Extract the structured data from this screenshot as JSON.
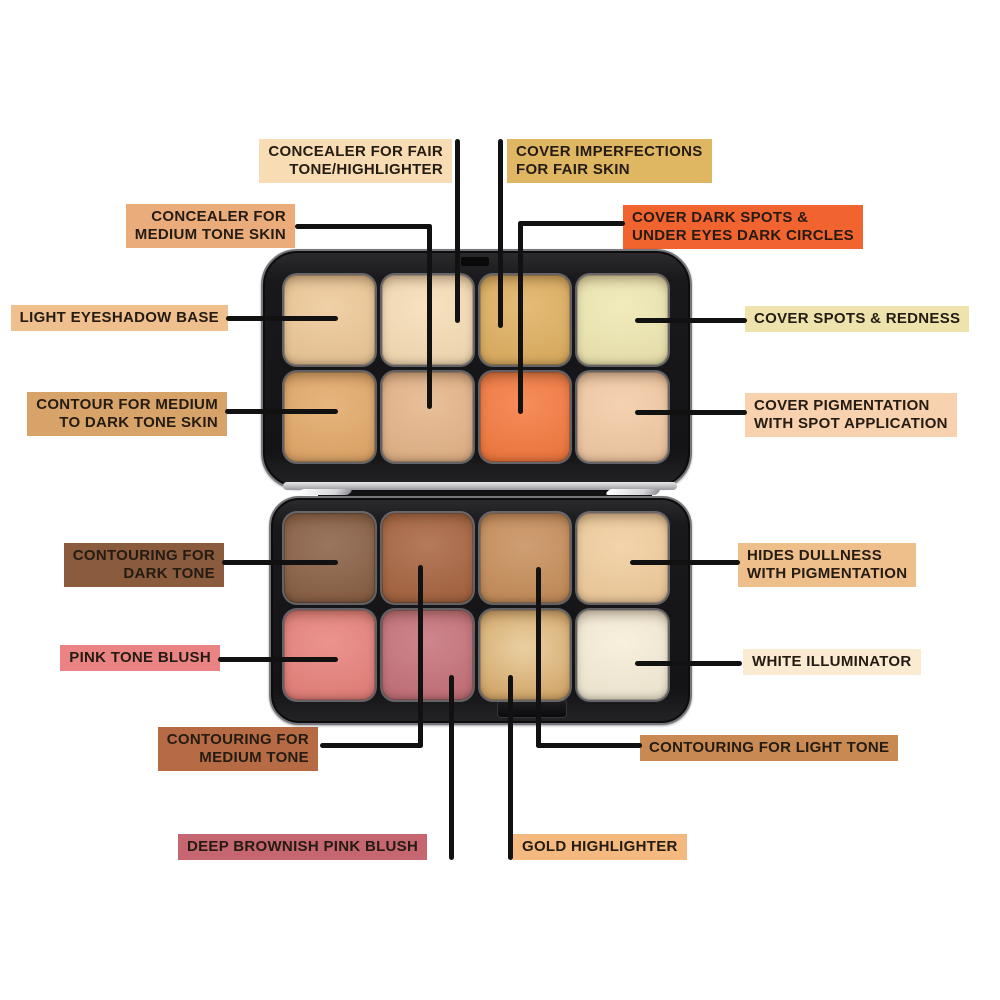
{
  "page": {
    "background": "#ffffff",
    "line_color": "#111111"
  },
  "palette": {
    "case_color": "#19191b",
    "top_pans": [
      {
        "name": "light-eyeshadow-base-pan",
        "color": "#EDC795"
      },
      {
        "name": "concealer-fair-highlighter-pan",
        "color": "#F6DCB3"
      },
      {
        "name": "cover-imperfections-fair-pan",
        "color": "#DFAE5D"
      },
      {
        "name": "cover-spots-redness-pan",
        "color": "#EFE7B0"
      },
      {
        "name": "contour-medium-dark-pan",
        "color": "#E2A765"
      },
      {
        "name": "concealer-medium-tone-pan",
        "color": "#E4B386"
      },
      {
        "name": "cover-dark-spots-pan",
        "color": "#F4773B"
      },
      {
        "name": "cover-pigmentation-pan",
        "color": "#F3C9A2"
      }
    ],
    "bottom_pans": [
      {
        "name": "contouring-dark-tone-pan",
        "color": "#875C40"
      },
      {
        "name": "contouring-medium-tone-pan",
        "color": "#A5613C"
      },
      {
        "name": "contouring-light-tone-pan",
        "color": "#C68C57"
      },
      {
        "name": "hides-dullness-pan",
        "color": "#F1CC9B"
      },
      {
        "name": "pink-tone-blush-pan",
        "color": "#E87F79"
      },
      {
        "name": "deep-brownish-pink-blush-pan",
        "color": "#C56E77"
      },
      {
        "name": "gold-highlighter-pan",
        "color": "#DBAD6C"
      },
      {
        "name": "white-illuminator-pan",
        "color": "#F6EDD6"
      }
    ]
  },
  "labels": [
    {
      "lines": [
        "CONCEALER FOR FAIR",
        "TONE/HIGHLIGHTER"
      ],
      "bg": "#F8DCB4",
      "points_to": "concealer-fair-highlighter-pan"
    },
    {
      "lines": [
        "COVER IMPERFECTIONS",
        "FOR FAIR SKIN"
      ],
      "bg": "#DFB763",
      "points_to": "cover-imperfections-fair-pan"
    },
    {
      "lines": [
        "CONCEALER FOR",
        "MEDIUM TONE SKIN"
      ],
      "bg": "#EBAC7C",
      "points_to": "concealer-medium-tone-pan"
    },
    {
      "lines": [
        "COVER DARK SPOTS &",
        "UNDER EYES DARK CIRCLES"
      ],
      "bg": "#F2642F",
      "points_to": "cover-dark-spots-pan"
    },
    {
      "lines": [
        "LIGHT EYESHADOW BASE"
      ],
      "bg": "#EFBF8D",
      "points_to": "light-eyeshadow-base-pan"
    },
    {
      "lines": [
        "COVER SPOTS & REDNESS"
      ],
      "bg": "#EEE3AC",
      "points_to": "cover-spots-redness-pan"
    },
    {
      "lines": [
        "CONTOUR FOR MEDIUM",
        "TO DARK TONE SKIN"
      ],
      "bg": "#D8A368",
      "points_to": "contour-medium-dark-pan"
    },
    {
      "lines": [
        "COVER PIGMENTATION",
        "WITH SPOT APPLICATION"
      ],
      "bg": "#F8D2AE",
      "points_to": "cover-pigmentation-pan"
    },
    {
      "lines": [
        "CONTOURING FOR",
        "DARK TONE"
      ],
      "bg": "#8A5B3D",
      "points_to": "contouring-dark-tone-pan"
    },
    {
      "lines": [
        "HIDES DULLNESS",
        "WITH PIGMENTATION"
      ],
      "bg": "#EEBE8B",
      "points_to": "hides-dullness-pan"
    },
    {
      "lines": [
        "PINK TONE BLUSH"
      ],
      "bg": "#EA8484",
      "points_to": "pink-tone-blush-pan"
    },
    {
      "lines": [
        "WHITE ILLUMINATOR"
      ],
      "bg": "#FAEBD2",
      "points_to": "white-illuminator-pan"
    },
    {
      "lines": [
        "CONTOURING FOR",
        "MEDIUM TONE"
      ],
      "bg": "#B66B44",
      "points_to": "contouring-medium-tone-pan"
    },
    {
      "lines": [
        "CONTOURING FOR LIGHT TONE"
      ],
      "bg": "#C88A52",
      "points_to": "contouring-light-tone-pan"
    },
    {
      "lines": [
        "DEEP BROWNISH PINK BLUSH"
      ],
      "bg": "#C56671",
      "points_to": "deep-brownish-pink-blush-pan"
    },
    {
      "lines": [
        "GOLD HIGHLIGHTER"
      ],
      "bg": "#F3B97E",
      "points_to": "gold-highlighter-pan"
    }
  ]
}
